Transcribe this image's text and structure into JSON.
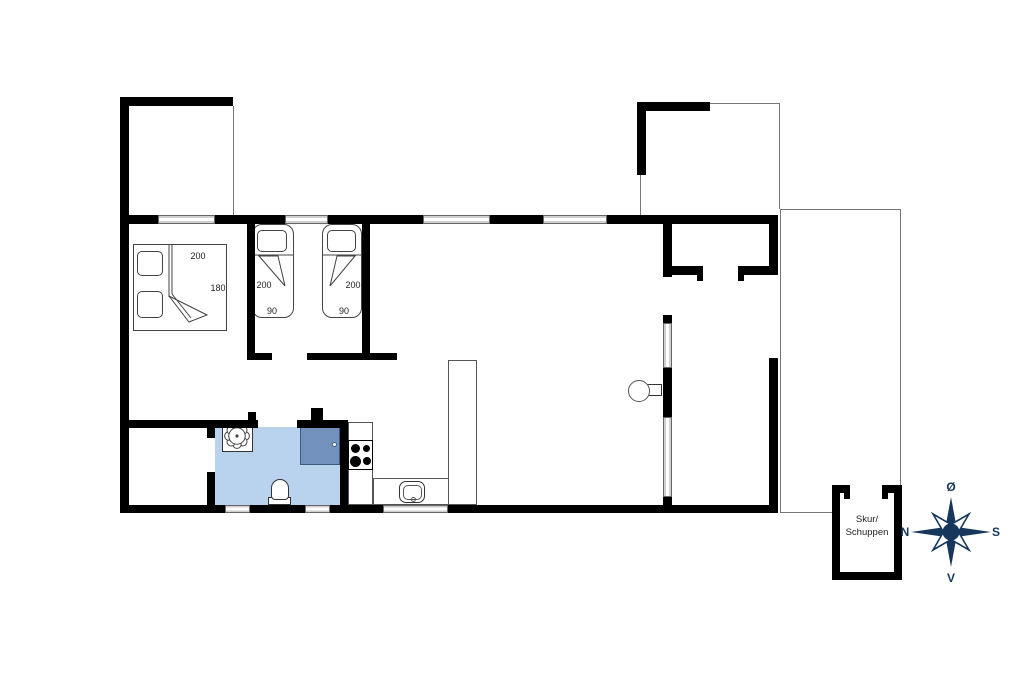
{
  "dimensions": {
    "double_bed": {
      "width_label": "200",
      "depth_label": "180"
    },
    "twin_bed_left": {
      "length_label": "200",
      "width_label": "90"
    },
    "twin_bed_right": {
      "length_label": "200",
      "width_label": "90"
    }
  },
  "shed": {
    "label_line1": "Skur/",
    "label_line2": "Schuppen"
  },
  "compass": {
    "top": "Ø",
    "right": "S",
    "bottom": "V",
    "left": "N"
  },
  "colors": {
    "wall": "#000000",
    "bathroom_floor": "#b9d3ef",
    "shower": "#7292bd",
    "window_fill": "#d9d9d9",
    "compass_navy": "#16365c",
    "line": "#777777",
    "label_text": "#222222"
  }
}
